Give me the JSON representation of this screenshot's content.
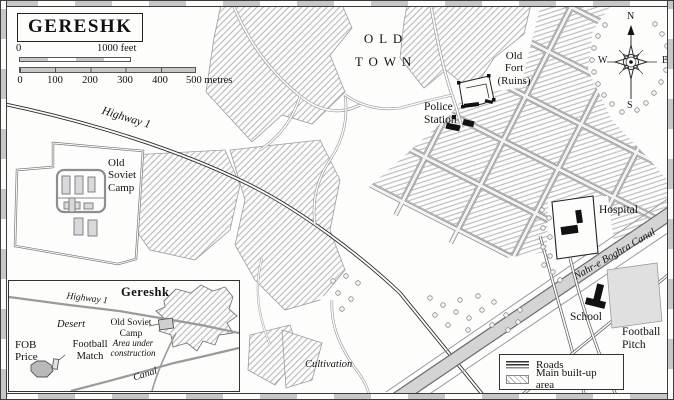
{
  "title": "GERESHK",
  "scale_bar": {
    "feet_start": "0",
    "feet_end": "1000 feet",
    "metre_ticks": [
      "0",
      "100",
      "200",
      "300",
      "400"
    ],
    "metre_end": "500 metres"
  },
  "compass": {
    "north": "N",
    "east": "E",
    "south": "S",
    "west": "W"
  },
  "map_labels": {
    "old_town": "OLD\nTOWN",
    "old_fort": "Old\nFort\n(Ruins)",
    "police_station": "Police\nStation",
    "highway": "Highway 1",
    "old_soviet_camp": "Old\nSoviet\nCamp",
    "hospital": "Hospital",
    "canal_name": "Nahr-e Boghra Canal",
    "school": "School",
    "football_pitch": "Football\nPitch",
    "cultivation": "Cultivation"
  },
  "legend": {
    "roads": "Roads",
    "built_up": "Main built-up area"
  },
  "inset": {
    "town": "Gereshk",
    "highway": "Highway 1",
    "desert": "Desert",
    "old_soviet_camp": "Old Soviet\nCamp",
    "construction": "Area under\nconstruction",
    "fob_price": "FOB\nPrice",
    "football_match": "Football\nMatch",
    "canal": "Canal"
  },
  "colors": {
    "background": "#fdfdfc",
    "hatch": "#b2b2b6",
    "road": "#3a3a3a",
    "canal_fill": "#d4d4d6",
    "building": "#111111",
    "text": "#131313"
  }
}
